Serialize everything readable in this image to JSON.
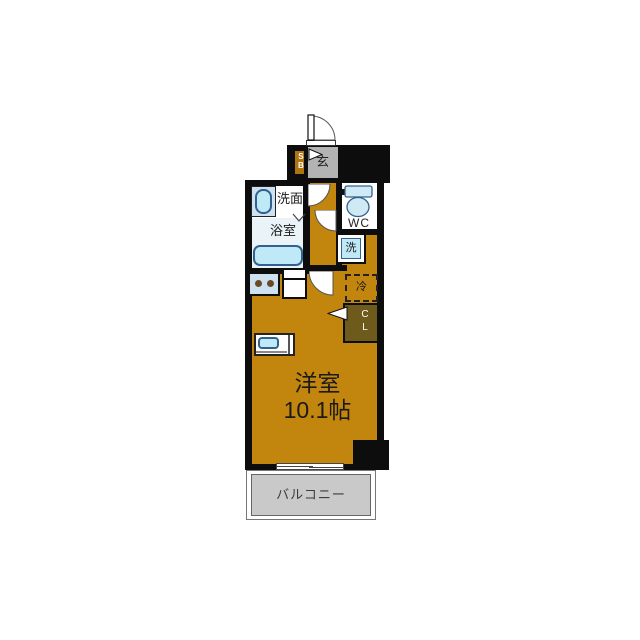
{
  "plan": {
    "title": "apartment-floor-plan",
    "labels": {
      "entrance": "玄",
      "shoe_box": "SB",
      "washroom": "洗面",
      "bathroom": "浴室",
      "toilet": "WC",
      "washer": "洗",
      "fridge": "冷",
      "closet": "CL",
      "main_room_name": "洋室",
      "main_room_size": "10.1帖",
      "balcony": "バルコニー"
    },
    "colors": {
      "wall": "#0d0d0d",
      "floor": "#c2850d",
      "entrance_floor": "#b3b3b3",
      "balcony_floor": "#c9c9c9",
      "bath_floor": "#e9f3f8",
      "closet_fill": "#6e5a1a",
      "shoebox_fill": "#ad7410",
      "fixture_blue": "#bfe9f6",
      "fixture_panel": "#cde1f0",
      "fixture_stroke": "#33618e",
      "burner_brown": "#6b4a23"
    }
  }
}
